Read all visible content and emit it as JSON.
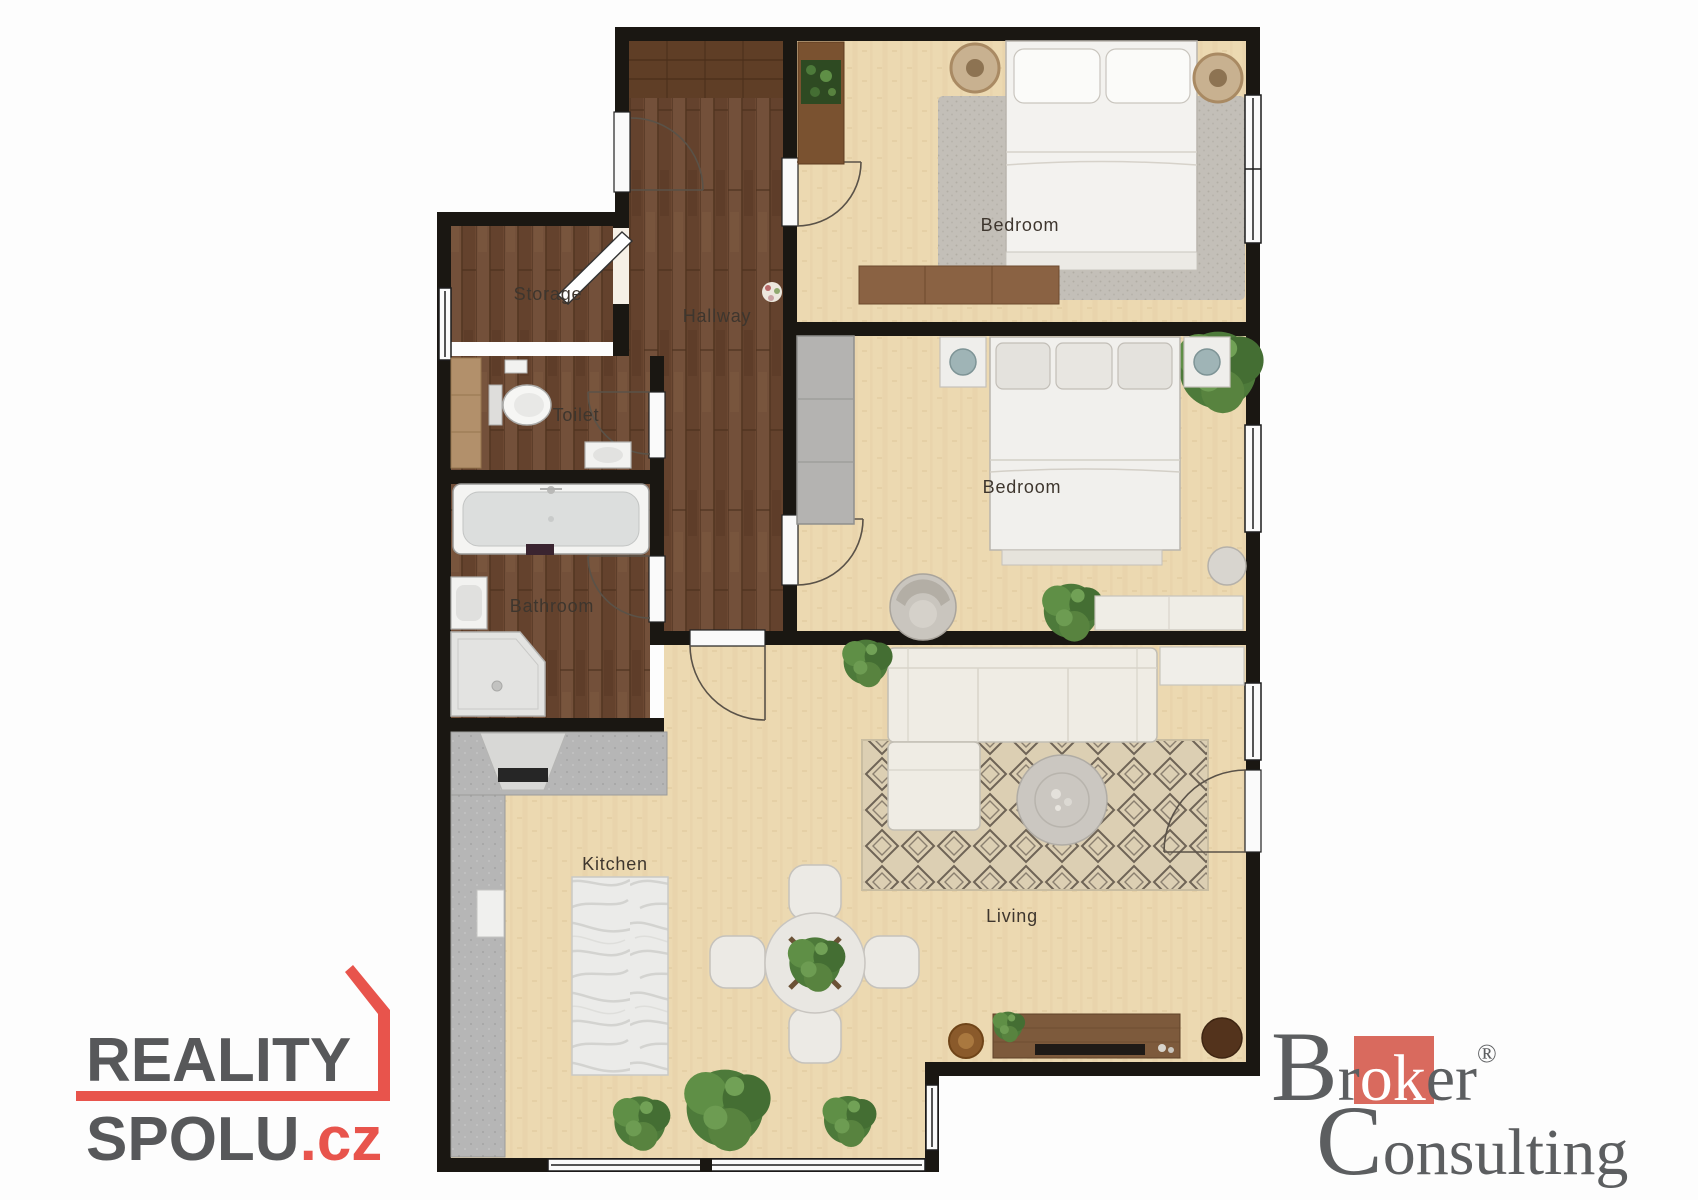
{
  "floorplan": {
    "rooms": [
      {
        "id": "storage",
        "label": "Storage"
      },
      {
        "id": "hallway",
        "label": "Hallway"
      },
      {
        "id": "toilet",
        "label": "Toilet"
      },
      {
        "id": "bathroom",
        "label": "Bathroom"
      },
      {
        "id": "bedroom_top",
        "label": "Bedroom"
      },
      {
        "id": "bedroom_middle",
        "label": "Bedroom"
      },
      {
        "id": "kitchen",
        "label": "Kitchen"
      },
      {
        "id": "living",
        "label": "Living"
      }
    ],
    "colors": {
      "wall": "#1a1712",
      "wood_floor": "#6c4832",
      "light_floor": "#ecd9b1",
      "bedroom_rug": "#c3bfb8",
      "living_rug": "#dccfb3",
      "counter_gray": "#b6b6b6"
    }
  },
  "branding": {
    "reality_spolu": {
      "line1": "REALITY",
      "line2": "SPOLU",
      "tld": ".cz",
      "text_color": "#57585a",
      "accent_color": "#e8544c"
    },
    "broker_consulting": {
      "word1_initial": "B",
      "word1_pre": "r",
      "word1_highlight": "ok",
      "word1_post": "er",
      "registered": "®",
      "word2_initial": "C",
      "word2_rest": "onsulting",
      "text_color": "#5c5e60",
      "accent_color": "#d96a5e"
    }
  }
}
